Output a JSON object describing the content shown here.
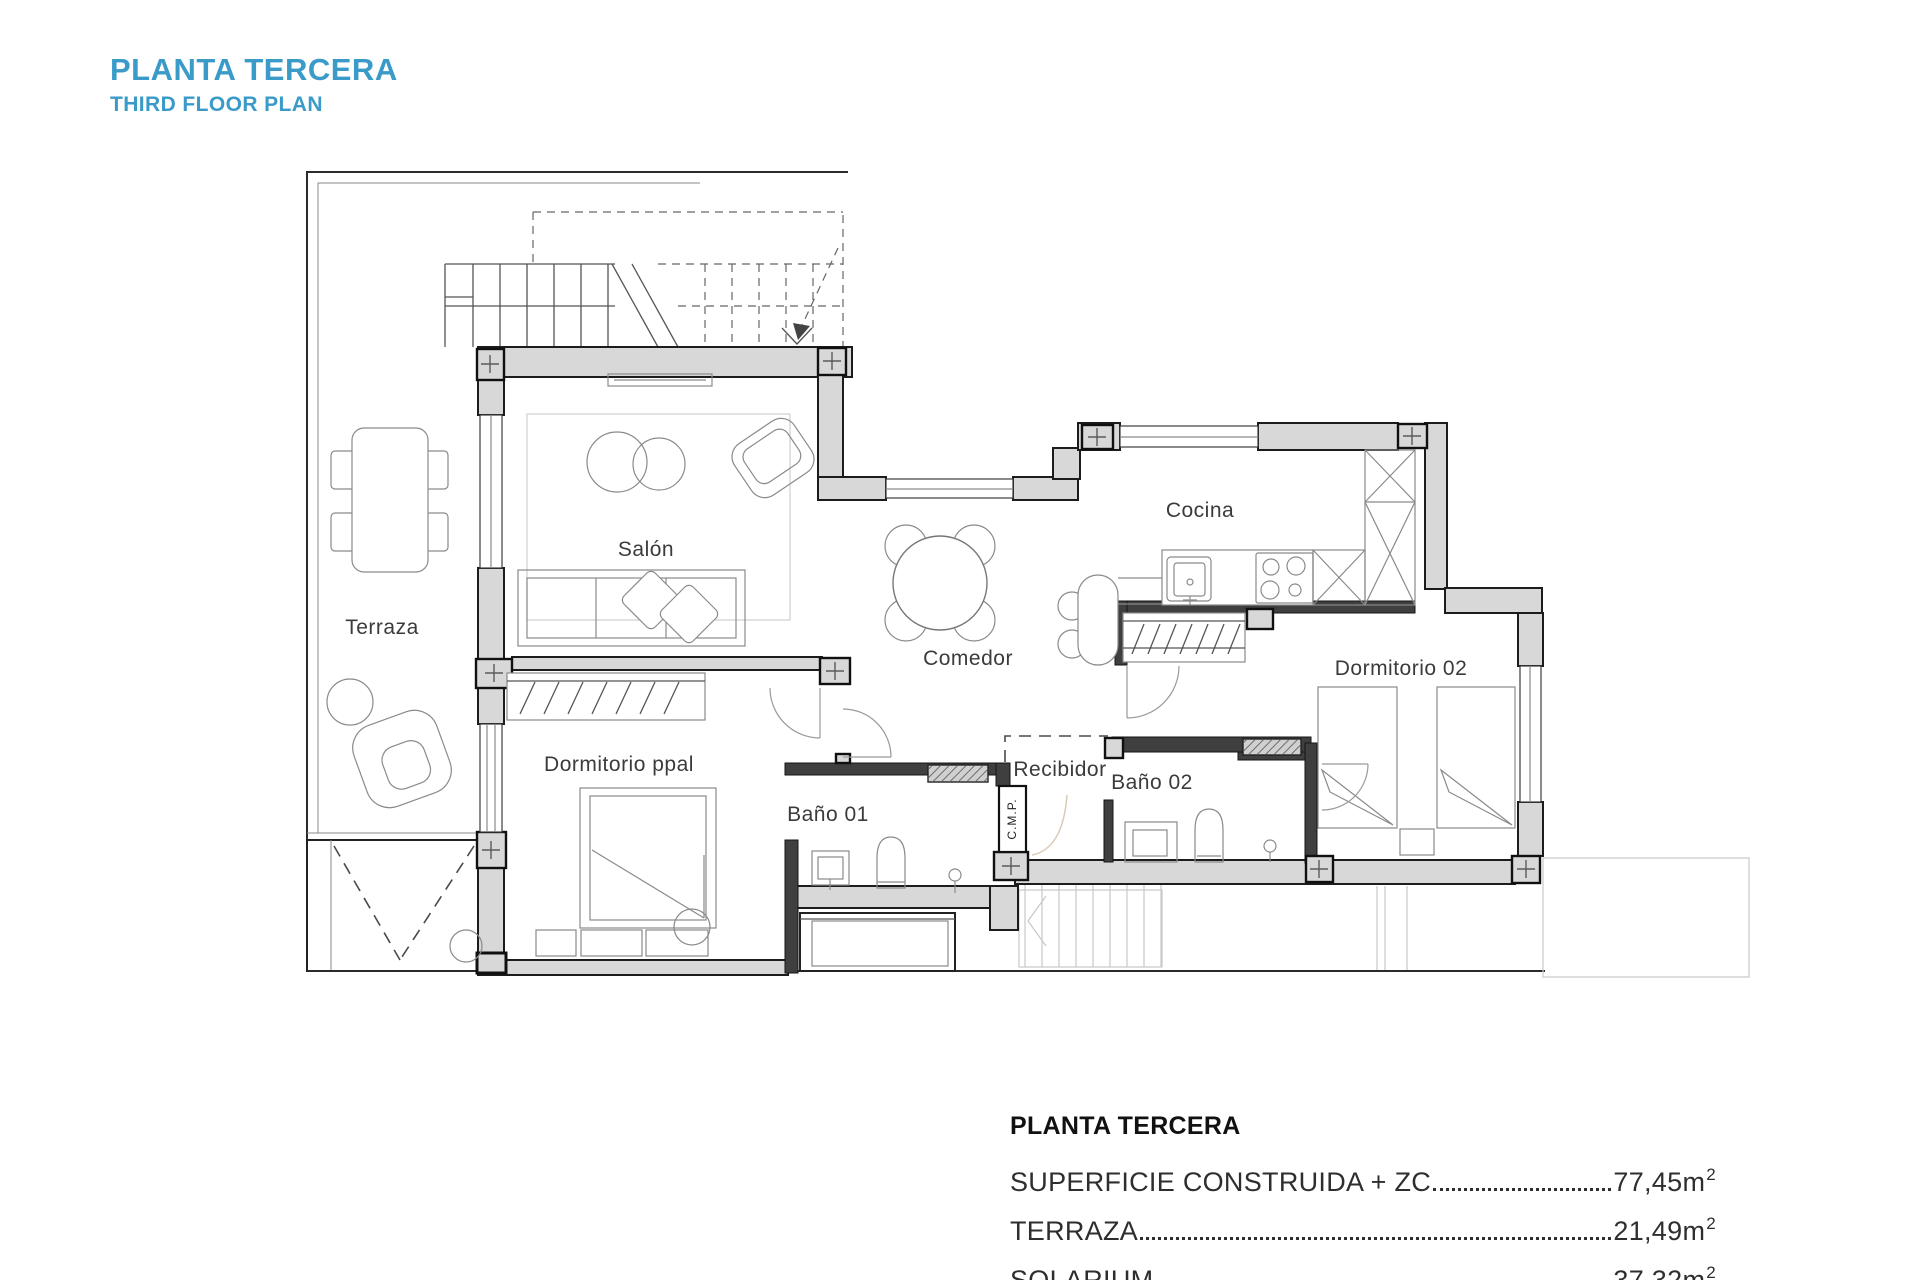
{
  "header": {
    "title": "PLANTA TERCERA",
    "subtitle": "THIRD FLOOR PLAN"
  },
  "plan": {
    "rooms": {
      "terraza": "Terraza",
      "salon": "Salón",
      "comedor": "Comedor",
      "cocina": "Cocina",
      "dormitorio_ppal": "Dormitorio ppal",
      "dormitorio_02": "Dormitorio 02",
      "bano_01": "Baño 01",
      "bano_02": "Baño 02",
      "recibidor": "Recibidor",
      "cmp": "C.M.P."
    }
  },
  "legend": {
    "title": "PLANTA TERCERA",
    "items": [
      {
        "label": "SUPERFICIE CONSTRUIDA + ZC",
        "value": "77,45m",
        "sup": "2"
      },
      {
        "label": "TERRAZA",
        "value": "21,49m",
        "sup": "2"
      },
      {
        "label": "SOLARIUM",
        "value": "37,32m",
        "sup": "2"
      }
    ]
  },
  "colors": {
    "accent": "#3a9bc9",
    "wall_fill": "#d8d8d8",
    "wall_dark": "#3f3f3f",
    "line": "#1c1c1c"
  }
}
